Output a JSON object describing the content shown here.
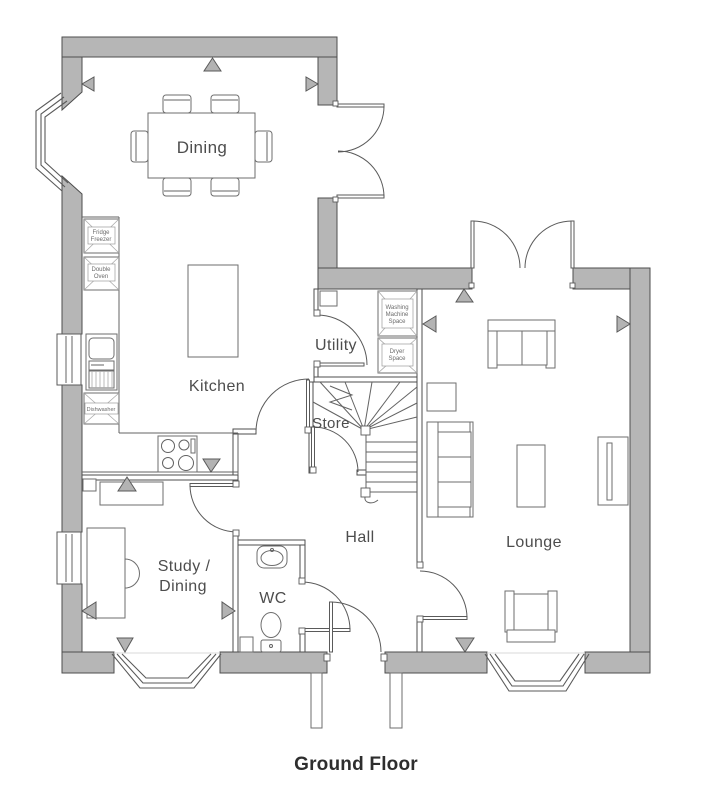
{
  "title": "Ground Floor",
  "rooms": {
    "dining": "Dining",
    "kitchen": "Kitchen",
    "utility": "Utility",
    "store": "Store",
    "hall": "Hall",
    "wc": "WC",
    "study_line1": "Study /",
    "study_line2": "Dining",
    "lounge": "Lounge"
  },
  "labels": {
    "fridge": [
      "Fridge",
      "Freezer"
    ],
    "double_oven": [
      "Double",
      "Oven"
    ],
    "dishwasher": "Dishwasher",
    "washing_machine": [
      "Washing",
      "Machine",
      "Space"
    ],
    "dryer": [
      "Dryer",
      "Space"
    ]
  },
  "colors": {
    "wall": "#b6b6b6",
    "wall_outline": "#4e4e4e",
    "furniture_line": "#6e6e6e",
    "label_text": "#4d4d4d",
    "title_text": "#2e2e2e"
  }
}
